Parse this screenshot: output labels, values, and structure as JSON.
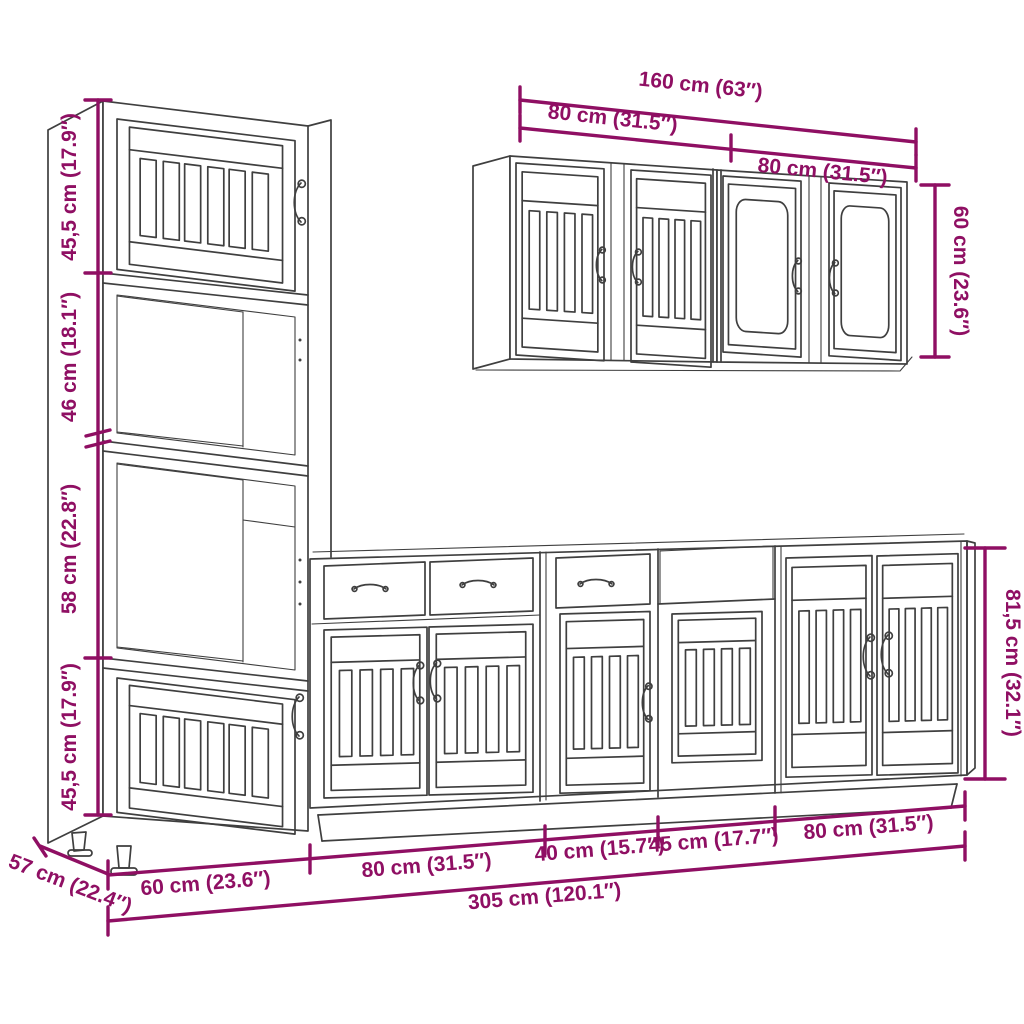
{
  "diagram": {
    "colors": {
      "dimension": "#8F0F63",
      "drawing_line": "#3f3f3f",
      "background": "#ffffff"
    },
    "labels": {
      "tall_sections": [
        "45,5 cm (17.9″)",
        "46 cm (18.1″)",
        "58 cm (22.8″)",
        "45,5 cm (17.9″)"
      ],
      "wall_total_width": "160 cm (63″)",
      "wall_left_width": "80 cm (31.5″)",
      "wall_right_width": "80 cm (31.5″)",
      "wall_height": "60 cm (23.6″)",
      "base_height": "81,5 cm (32.1″)",
      "base_widths": [
        "60 cm (23.6″)",
        "80 cm (31.5″)",
        "40 cm (15.7″)",
        "45 cm (17.7″)",
        "80 cm (31.5″)"
      ],
      "total_width": "305 cm (120.1″)",
      "depth": "57 cm (22.4″)"
    }
  }
}
